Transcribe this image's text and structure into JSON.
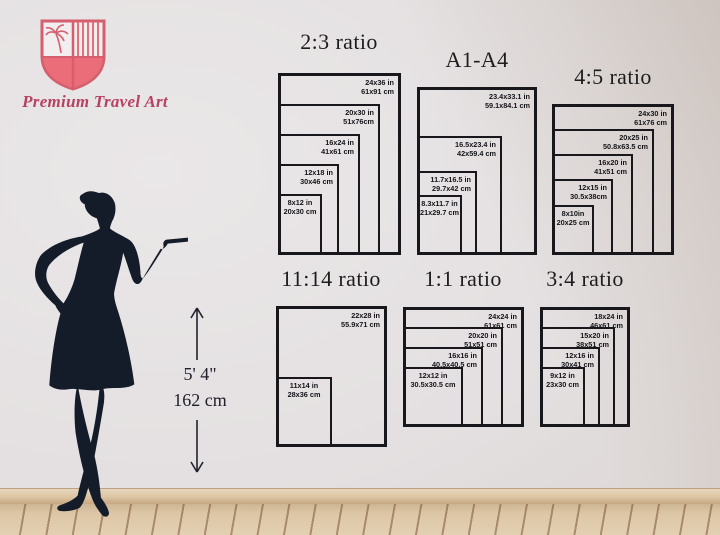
{
  "brand": {
    "name": "Premium Travel Art"
  },
  "height_marker": {
    "imperial": "5' 4\"",
    "metric": "162 cm"
  },
  "groups": [
    {
      "title": "2:3 ratio",
      "sizes": [
        {
          "in": "24x36 in",
          "cm": "61x91 cm"
        },
        {
          "in": "20x30 in",
          "cm": "51x76cm"
        },
        {
          "in": "16x24 in",
          "cm": "41x61 cm"
        },
        {
          "in": "12x18 in",
          "cm": "30x46 cm"
        },
        {
          "in": "8x12 in",
          "cm": "20x30 cm"
        }
      ]
    },
    {
      "title": "A1-A4",
      "sizes": [
        {
          "in": "23.4x33.1 in",
          "cm": "59.1x84.1 cm"
        },
        {
          "in": "16.5x23.4 in",
          "cm": "42x59.4 cm"
        },
        {
          "in": "11.7x16.5 in",
          "cm": "29.7x42 cm"
        },
        {
          "in": "8.3x11.7 in",
          "cm": "21x29.7 cm"
        }
      ]
    },
    {
      "title": "4:5 ratio",
      "sizes": [
        {
          "in": "24x30 in",
          "cm": "61x76 cm"
        },
        {
          "in": "20x25 in",
          "cm": "50.8x63.5 cm"
        },
        {
          "in": "16x20 in",
          "cm": "41x51 cm"
        },
        {
          "in": "12x15 in",
          "cm": "30.5x38cm"
        },
        {
          "in": "8x10in",
          "cm": "20x25 cm"
        }
      ]
    },
    {
      "title": "11:14 ratio",
      "sizes": [
        {
          "in": "22x28 in",
          "cm": "55.9x71 cm"
        },
        {
          "in": "11x14 in",
          "cm": "28x36 cm"
        }
      ]
    },
    {
      "title": "1:1 ratio",
      "sizes": [
        {
          "in": "24x24 in",
          "cm": "61x61 cm"
        },
        {
          "in": "20x20 in",
          "cm": "51x51 cm"
        },
        {
          "in": "16x16 in",
          "cm": "40.5x40.5 cm"
        },
        {
          "in": "12x12 in",
          "cm": "30.5x30.5 cm"
        }
      ]
    },
    {
      "title": "3:4 ratio",
      "sizes": [
        {
          "in": "18x24 in",
          "cm": "46x61 cm"
        },
        {
          "in": "15x20 in",
          "cm": "38x51 cm"
        },
        {
          "in": "12x16 in",
          "cm": "30x41 cm"
        },
        {
          "in": "9x12 in",
          "cm": "23x30 cm"
        }
      ]
    }
  ],
  "colors": {
    "accent_pink": "#e06a77",
    "brand_text": "#b54163",
    "frame_line": "#17171c",
    "silhouette_navy": "#131c28",
    "wood_floor": "#dcc6a6",
    "wall": "#e4e0e1"
  }
}
